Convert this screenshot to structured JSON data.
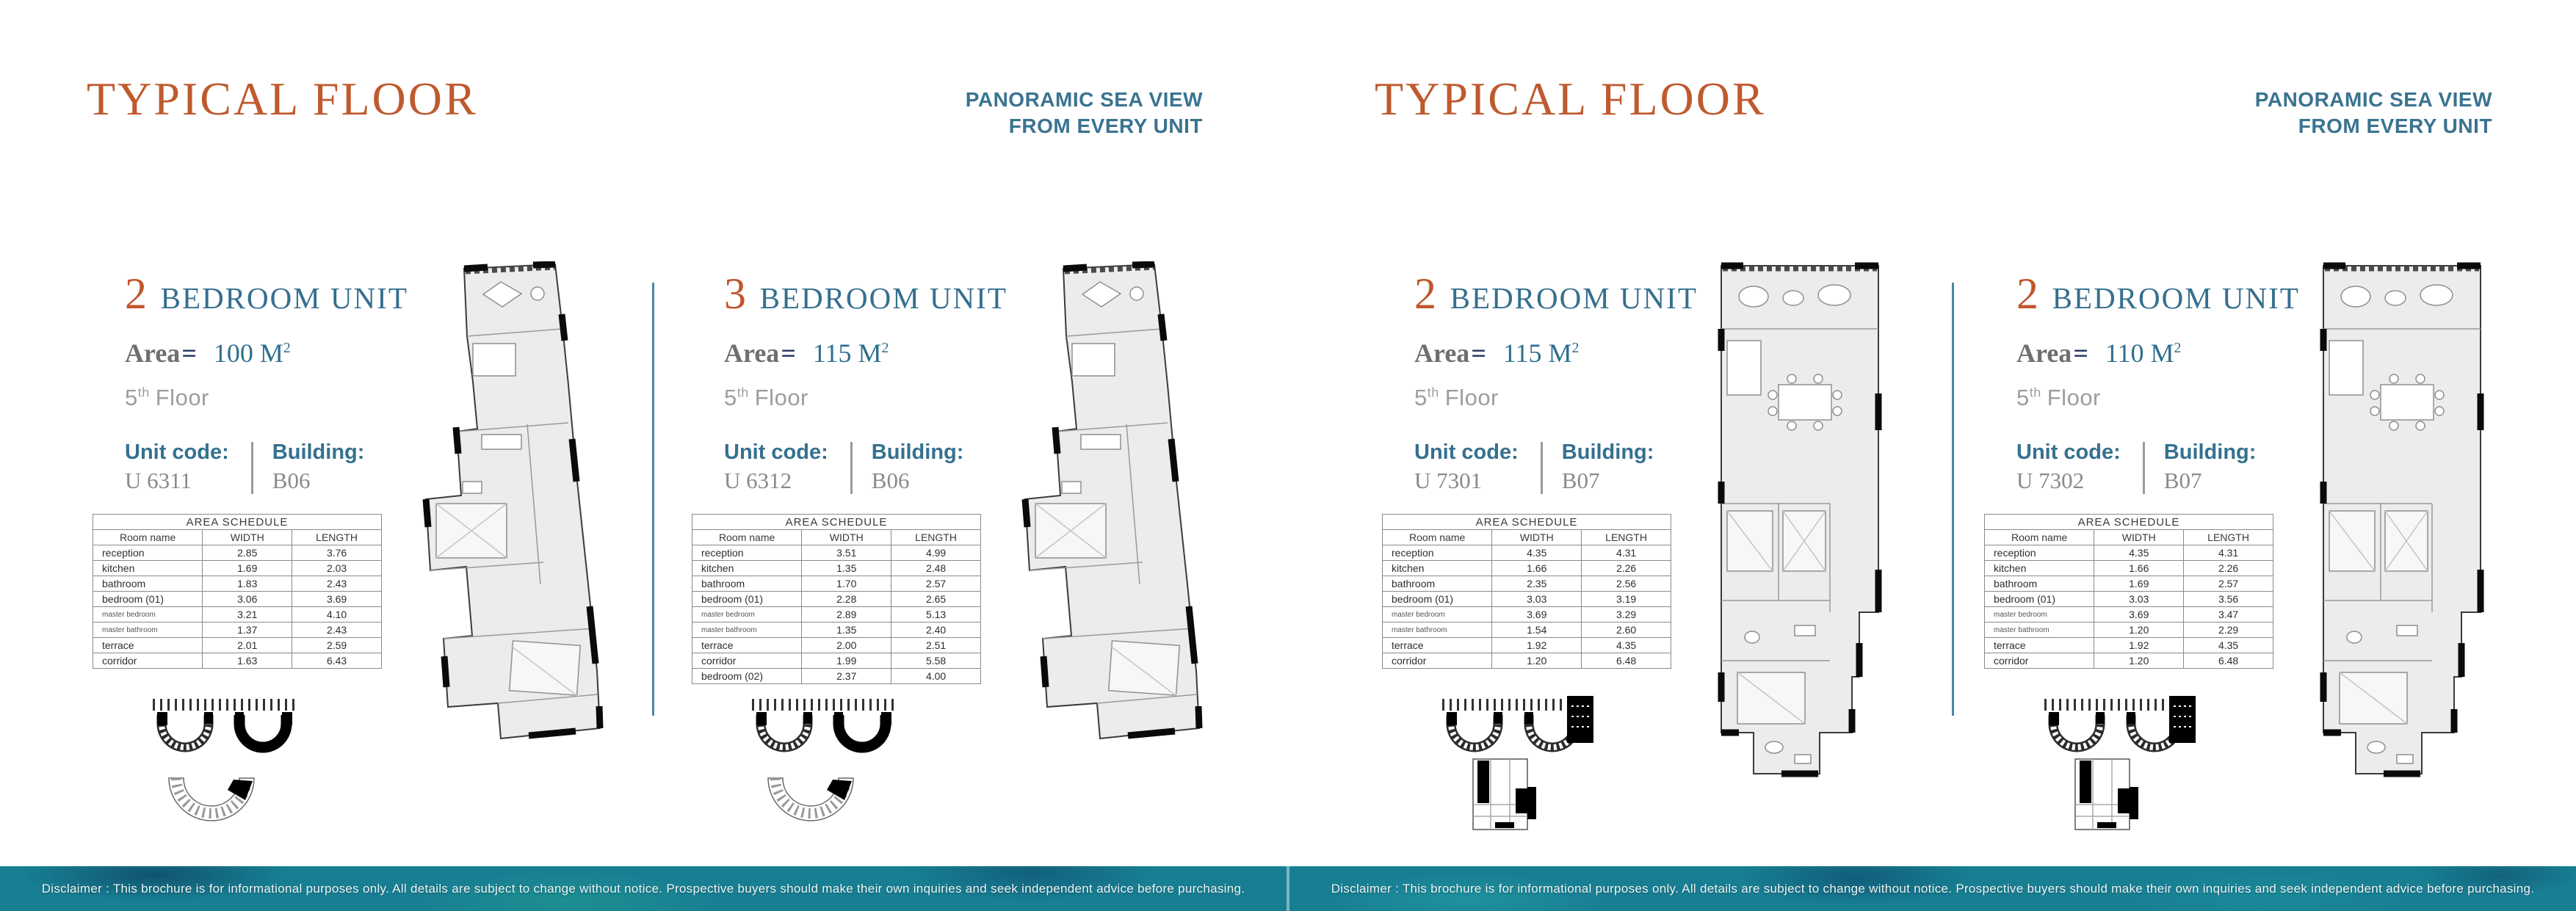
{
  "colors": {
    "accent_orange": "#c0572c",
    "heading_teal": "#356f8e",
    "label_teal": "#35718f",
    "body_gray": "#8a8a8a",
    "divider_blue": "#4c87a6",
    "strip_teal": "#187f93"
  },
  "pages": [
    {
      "title": "TYPICAL FLOOR",
      "tagline": [
        "PANORAMIC SEA VIEW",
        "FROM EVERY UNIT"
      ],
      "disclaimer": "Disclaimer : This brochure is for informational purposes only. All details are subject to change without notice. Prospective buyers should make their own inquiries and seek independent advice before purchasing.",
      "units": [
        {
          "bedrooms": "2",
          "type_label": "BEDROOM UNIT",
          "area_label": "Area",
          "equals": "=",
          "area_value": "100 M",
          "area_sup": "2",
          "floor_num": "5",
          "floor_ord": "th",
          "floor_word": "Floor",
          "unit_code_label": "Unit code:",
          "unit_code": "U 6311",
          "building_label": "Building:",
          "building": "B06",
          "schedule": {
            "title": "AREA SCHEDULE",
            "headers": [
              "Room name",
              "WIDTH",
              "LENGTH"
            ],
            "rows": [
              [
                "reception",
                "2.85",
                "3.76"
              ],
              [
                "kitchen",
                "1.69",
                "2.03"
              ],
              [
                "bathroom",
                "1.83",
                "2.43"
              ],
              [
                "bedroom (01)",
                "3.06",
                "3.69"
              ],
              [
                "master bedroom",
                "3.21",
                "4.10"
              ],
              [
                "master bathroom",
                "1.37",
                "2.43"
              ],
              [
                "terrace",
                "2.01",
                "2.59"
              ],
              [
                "corridor",
                "1.63",
                "6.43"
              ]
            ]
          }
        },
        {
          "bedrooms": "3",
          "type_label": "BEDROOM UNIT",
          "area_label": "Area",
          "equals": "=",
          "area_value": "115 M",
          "area_sup": "2",
          "floor_num": "5",
          "floor_ord": "th",
          "floor_word": "Floor",
          "unit_code_label": "Unit code:",
          "unit_code": "U 6312",
          "building_label": "Building:",
          "building": "B06",
          "schedule": {
            "title": "AREA SCHEDULE",
            "headers": [
              "Room name",
              "WIDTH",
              "LENGTH"
            ],
            "rows": [
              [
                "reception",
                "3.51",
                "4.99"
              ],
              [
                "kitchen",
                "1.35",
                "2.48"
              ],
              [
                "bathroom",
                "1.70",
                "2.57"
              ],
              [
                "bedroom (01)",
                "2.28",
                "2.65"
              ],
              [
                "master bedroom",
                "2.89",
                "5.13"
              ],
              [
                "master bathroom",
                "1.35",
                "2.40"
              ],
              [
                "terrace",
                "2.00",
                "2.51"
              ],
              [
                "corridor",
                "1.99",
                "5.58"
              ],
              [
                "bedroom (02)",
                "2.37",
                "4.00"
              ]
            ]
          }
        }
      ]
    },
    {
      "title": "TYPICAL FLOOR",
      "tagline": [
        "PANORAMIC SEA VIEW",
        "FROM EVERY UNIT"
      ],
      "disclaimer": "Disclaimer : This brochure is for informational purposes only. All details are subject to change without notice. Prospective buyers should make their own inquiries and seek independent advice before purchasing.",
      "units": [
        {
          "bedrooms": "2",
          "type_label": "BEDROOM UNIT",
          "area_label": "Area",
          "equals": "=",
          "area_value": "115 M",
          "area_sup": "2",
          "floor_num": "5",
          "floor_ord": "th",
          "floor_word": "Floor",
          "unit_code_label": "Unit code:",
          "unit_code": "U 7301",
          "building_label": "Building:",
          "building": "B07",
          "schedule": {
            "title": "AREA SCHEDULE",
            "headers": [
              "Room name",
              "WIDTH",
              "LENGTH"
            ],
            "rows": [
              [
                "reception",
                "4.35",
                "4.31"
              ],
              [
                "kitchen",
                "1.66",
                "2.26"
              ],
              [
                "bathroom",
                "2.35",
                "2.56"
              ],
              [
                "bedroom (01)",
                "3.03",
                "3.19"
              ],
              [
                "master bedroom",
                "3.69",
                "3.29"
              ],
              [
                "master bathroom",
                "1.54",
                "2.60"
              ],
              [
                "terrace",
                "1.92",
                "4.35"
              ],
              [
                "corridor",
                "1.20",
                "6.48"
              ]
            ]
          }
        },
        {
          "bedrooms": "2",
          "type_label": "BEDROOM UNIT",
          "area_label": "Area",
          "equals": "=",
          "area_value": "110 M",
          "area_sup": "2",
          "floor_num": "5",
          "floor_ord": "th",
          "floor_word": "Floor",
          "unit_code_label": "Unit code:",
          "unit_code": "U 7302",
          "building_label": "Building:",
          "building": "B07",
          "schedule": {
            "title": "AREA SCHEDULE",
            "headers": [
              "Room name",
              "WIDTH",
              "LENGTH"
            ],
            "rows": [
              [
                "reception",
                "4.35",
                "4.31"
              ],
              [
                "kitchen",
                "1.66",
                "2.26"
              ],
              [
                "bathroom",
                "1.69",
                "2.57"
              ],
              [
                "bedroom (01)",
                "3.03",
                "3.56"
              ],
              [
                "master bedroom",
                "3.69",
                "3.47"
              ],
              [
                "master bathroom",
                "1.20",
                "2.29"
              ],
              [
                "terrace",
                "1.92",
                "4.35"
              ],
              [
                "corridor",
                "1.20",
                "6.48"
              ]
            ]
          }
        }
      ]
    }
  ]
}
